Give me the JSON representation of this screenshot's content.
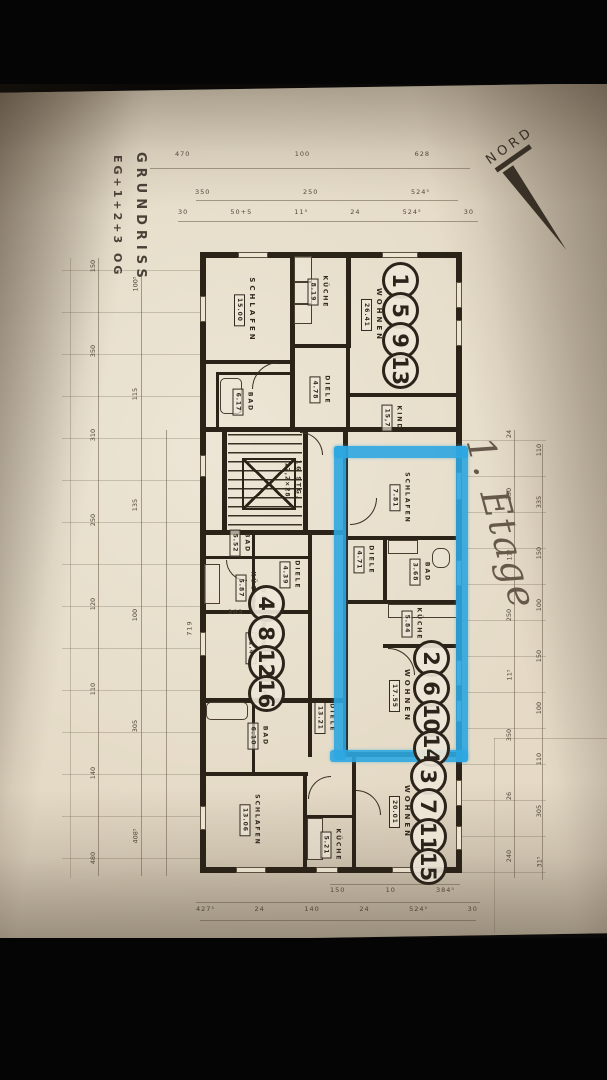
{
  "annotations": {
    "title_line1": "GRUNDRISS",
    "title_line2": "EG+1+2+3 OG",
    "north": "NORD",
    "handwritten_floor": "1. Etage",
    "stair_note_line1": "16 STG.",
    "stair_note_line2": "17,2×28"
  },
  "rooms": {
    "schlafen_top": {
      "label": "SCHLAFEN",
      "area": "15.00"
    },
    "kueche_top": {
      "label": "KÜCHE",
      "area": "8.19"
    },
    "diele_top": {
      "label": "DIELE",
      "area": "4.78"
    },
    "bad_top": {
      "label": "BAD",
      "area": "6.17"
    },
    "wohnen_top": {
      "label": "WOHNEN",
      "area": "26.41"
    },
    "kind_top": {
      "label": "KIND",
      "area": "15,7"
    },
    "schlafen_blue": {
      "label": "SCHLAFEN",
      "area": "7.81"
    },
    "diele_blue": {
      "label": "DIELE",
      "area": "4.71"
    },
    "bad_blue": {
      "label": "BAD",
      "area": "3.68"
    },
    "kueche_blue": {
      "label": "KÜCHE",
      "area": "5.84"
    },
    "wohnen_blue": {
      "label": "WOHNEN",
      "area": "17.55"
    },
    "wohnen_schlafen_left": {
      "label": "WOHNEN UND SCHLAFEN",
      "area": "21.48"
    },
    "kueche_left": {
      "label": "KÜCHE",
      "area": "5.87"
    },
    "bad_left": {
      "label": "BAD",
      "area": "5.52"
    },
    "diele_left": {
      "label": "DIELE",
      "area": "4.39"
    },
    "diele_mid": {
      "label": "DIELE",
      "area": "13.21"
    },
    "wohnen_bottom": {
      "label": "WOHNEN",
      "area": "20.01"
    },
    "schlafen_bottom": {
      "label": "SCHLAFEN",
      "area": "13.06"
    },
    "kueche_bottom": {
      "label": "KÜCHE",
      "area": "5.21"
    },
    "bad_bottom": {
      "label": "BAD",
      "area": "6.10"
    }
  },
  "units": {
    "top": [
      "1",
      "5",
      "9",
      "13"
    ],
    "middle": [
      "2",
      "6",
      "10",
      "14"
    ],
    "bottom": [
      "3",
      "7",
      "11",
      "15"
    ],
    "left": [
      "4",
      "8",
      "12",
      "16"
    ]
  },
  "dimensions": {
    "top_row1": [
      "470",
      "100",
      "628"
    ],
    "top_row2": [
      "350",
      "250",
      "524⁵"
    ],
    "top_row3": [
      "30",
      "50+5",
      "11⁵",
      "24",
      "524⁵",
      "30"
    ],
    "bottom_row1": [
      "150",
      "10",
      "384⁵"
    ],
    "bottom_row2": [
      "427⁵",
      "24",
      "140",
      "24",
      "524⁵",
      "30"
    ],
    "left_col1": [
      "150",
      "350",
      "310",
      "250",
      "120",
      "110",
      "140",
      "480"
    ],
    "left_col2": [
      "100⁵",
      "115",
      "135",
      "100",
      "305",
      "408⁵"
    ],
    "right_col1": [
      "110",
      "335",
      "150",
      "100",
      "150",
      "100",
      "110",
      "305",
      "31⁵"
    ],
    "right_col2": [
      "24",
      "350",
      "11⁵",
      "250",
      "11⁵",
      "350",
      "26",
      "240"
    ],
    "interior1": "303",
    "interior2": "719"
  },
  "colors": {
    "highlight": "#2ea7e1",
    "paper": "#e4dac6",
    "ink": "#2c2318"
  }
}
